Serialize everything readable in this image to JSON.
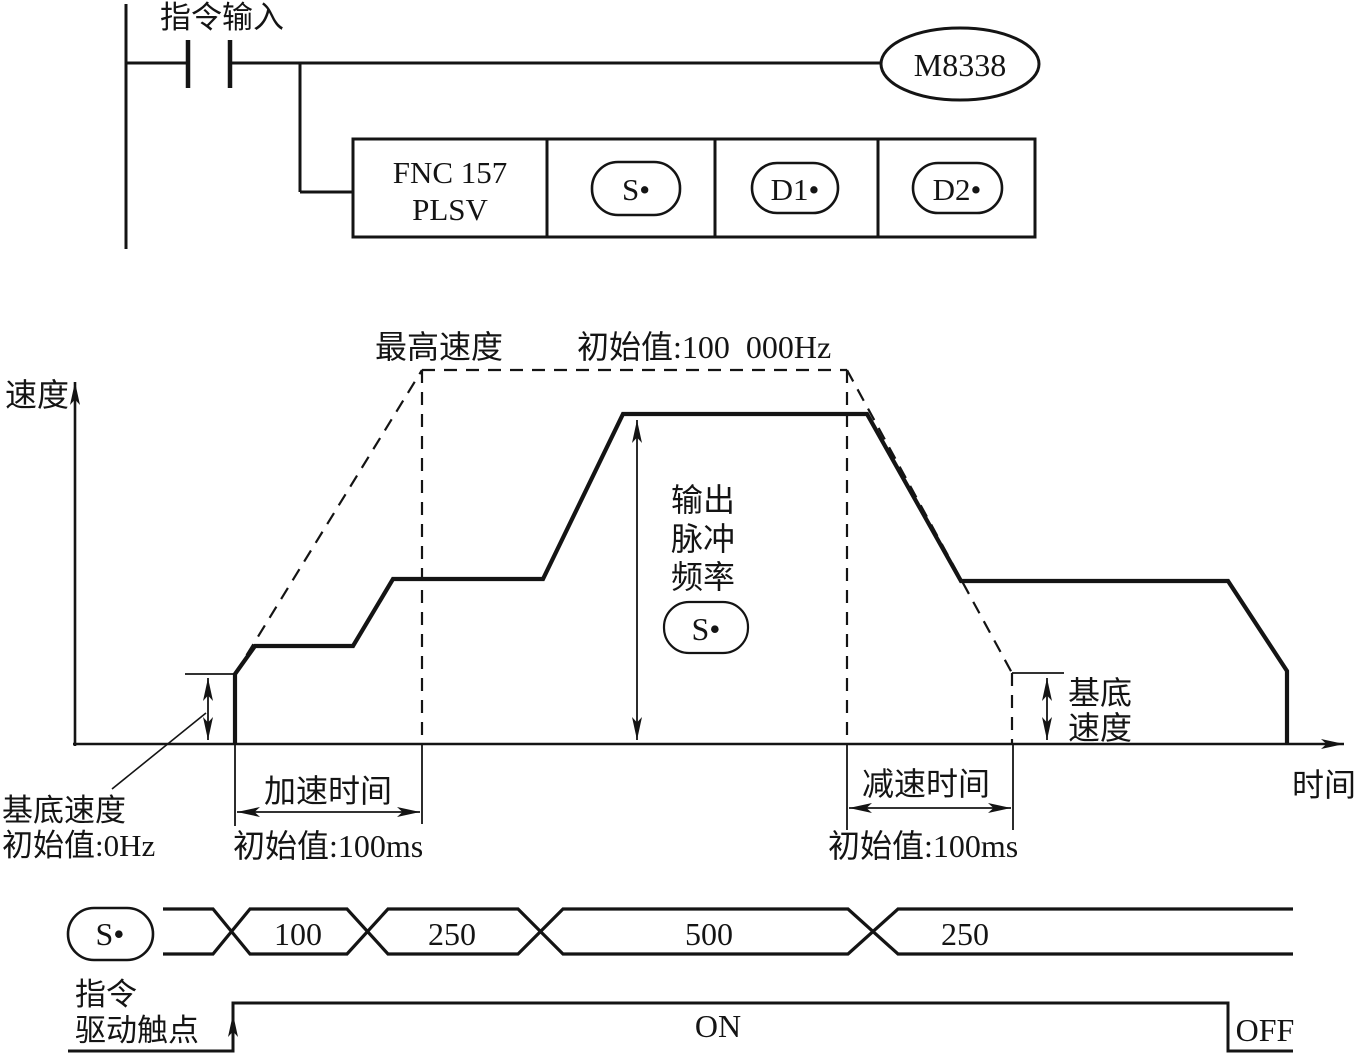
{
  "colors": {
    "ink": "#141414",
    "background": "#ffffff"
  },
  "ladder": {
    "input_label": "指令输入",
    "coil": "M8338",
    "instruction_line1": "FNC 157",
    "instruction_line2": "PLSV",
    "operand_s": "S•",
    "operand_d1": "D1•",
    "operand_d2": "D2•"
  },
  "chart": {
    "y_label": "速度",
    "x_label": "时间",
    "max_speed": "最高速度",
    "max_speed_initial": "初始值:100  000Hz",
    "out_line1": "输出",
    "out_line2": "脉冲",
    "out_line3": "频率",
    "operand_s": "S•",
    "base_right_line1": "基底",
    "base_right_line2": "速度",
    "base_left_line1": "基底速度",
    "base_left_line2": "初始值:0Hz",
    "accel": "加速时间",
    "accel_initial": "初始值:100ms",
    "decel": "减速时间",
    "decel_initial": "初始值:100ms"
  },
  "timing": {
    "operand_s": "S•",
    "values": [
      "100",
      "250",
      "500",
      "250"
    ],
    "contact_line1": "指令",
    "contact_line2": "驱动触点",
    "on": "ON",
    "off": "OFF"
  }
}
